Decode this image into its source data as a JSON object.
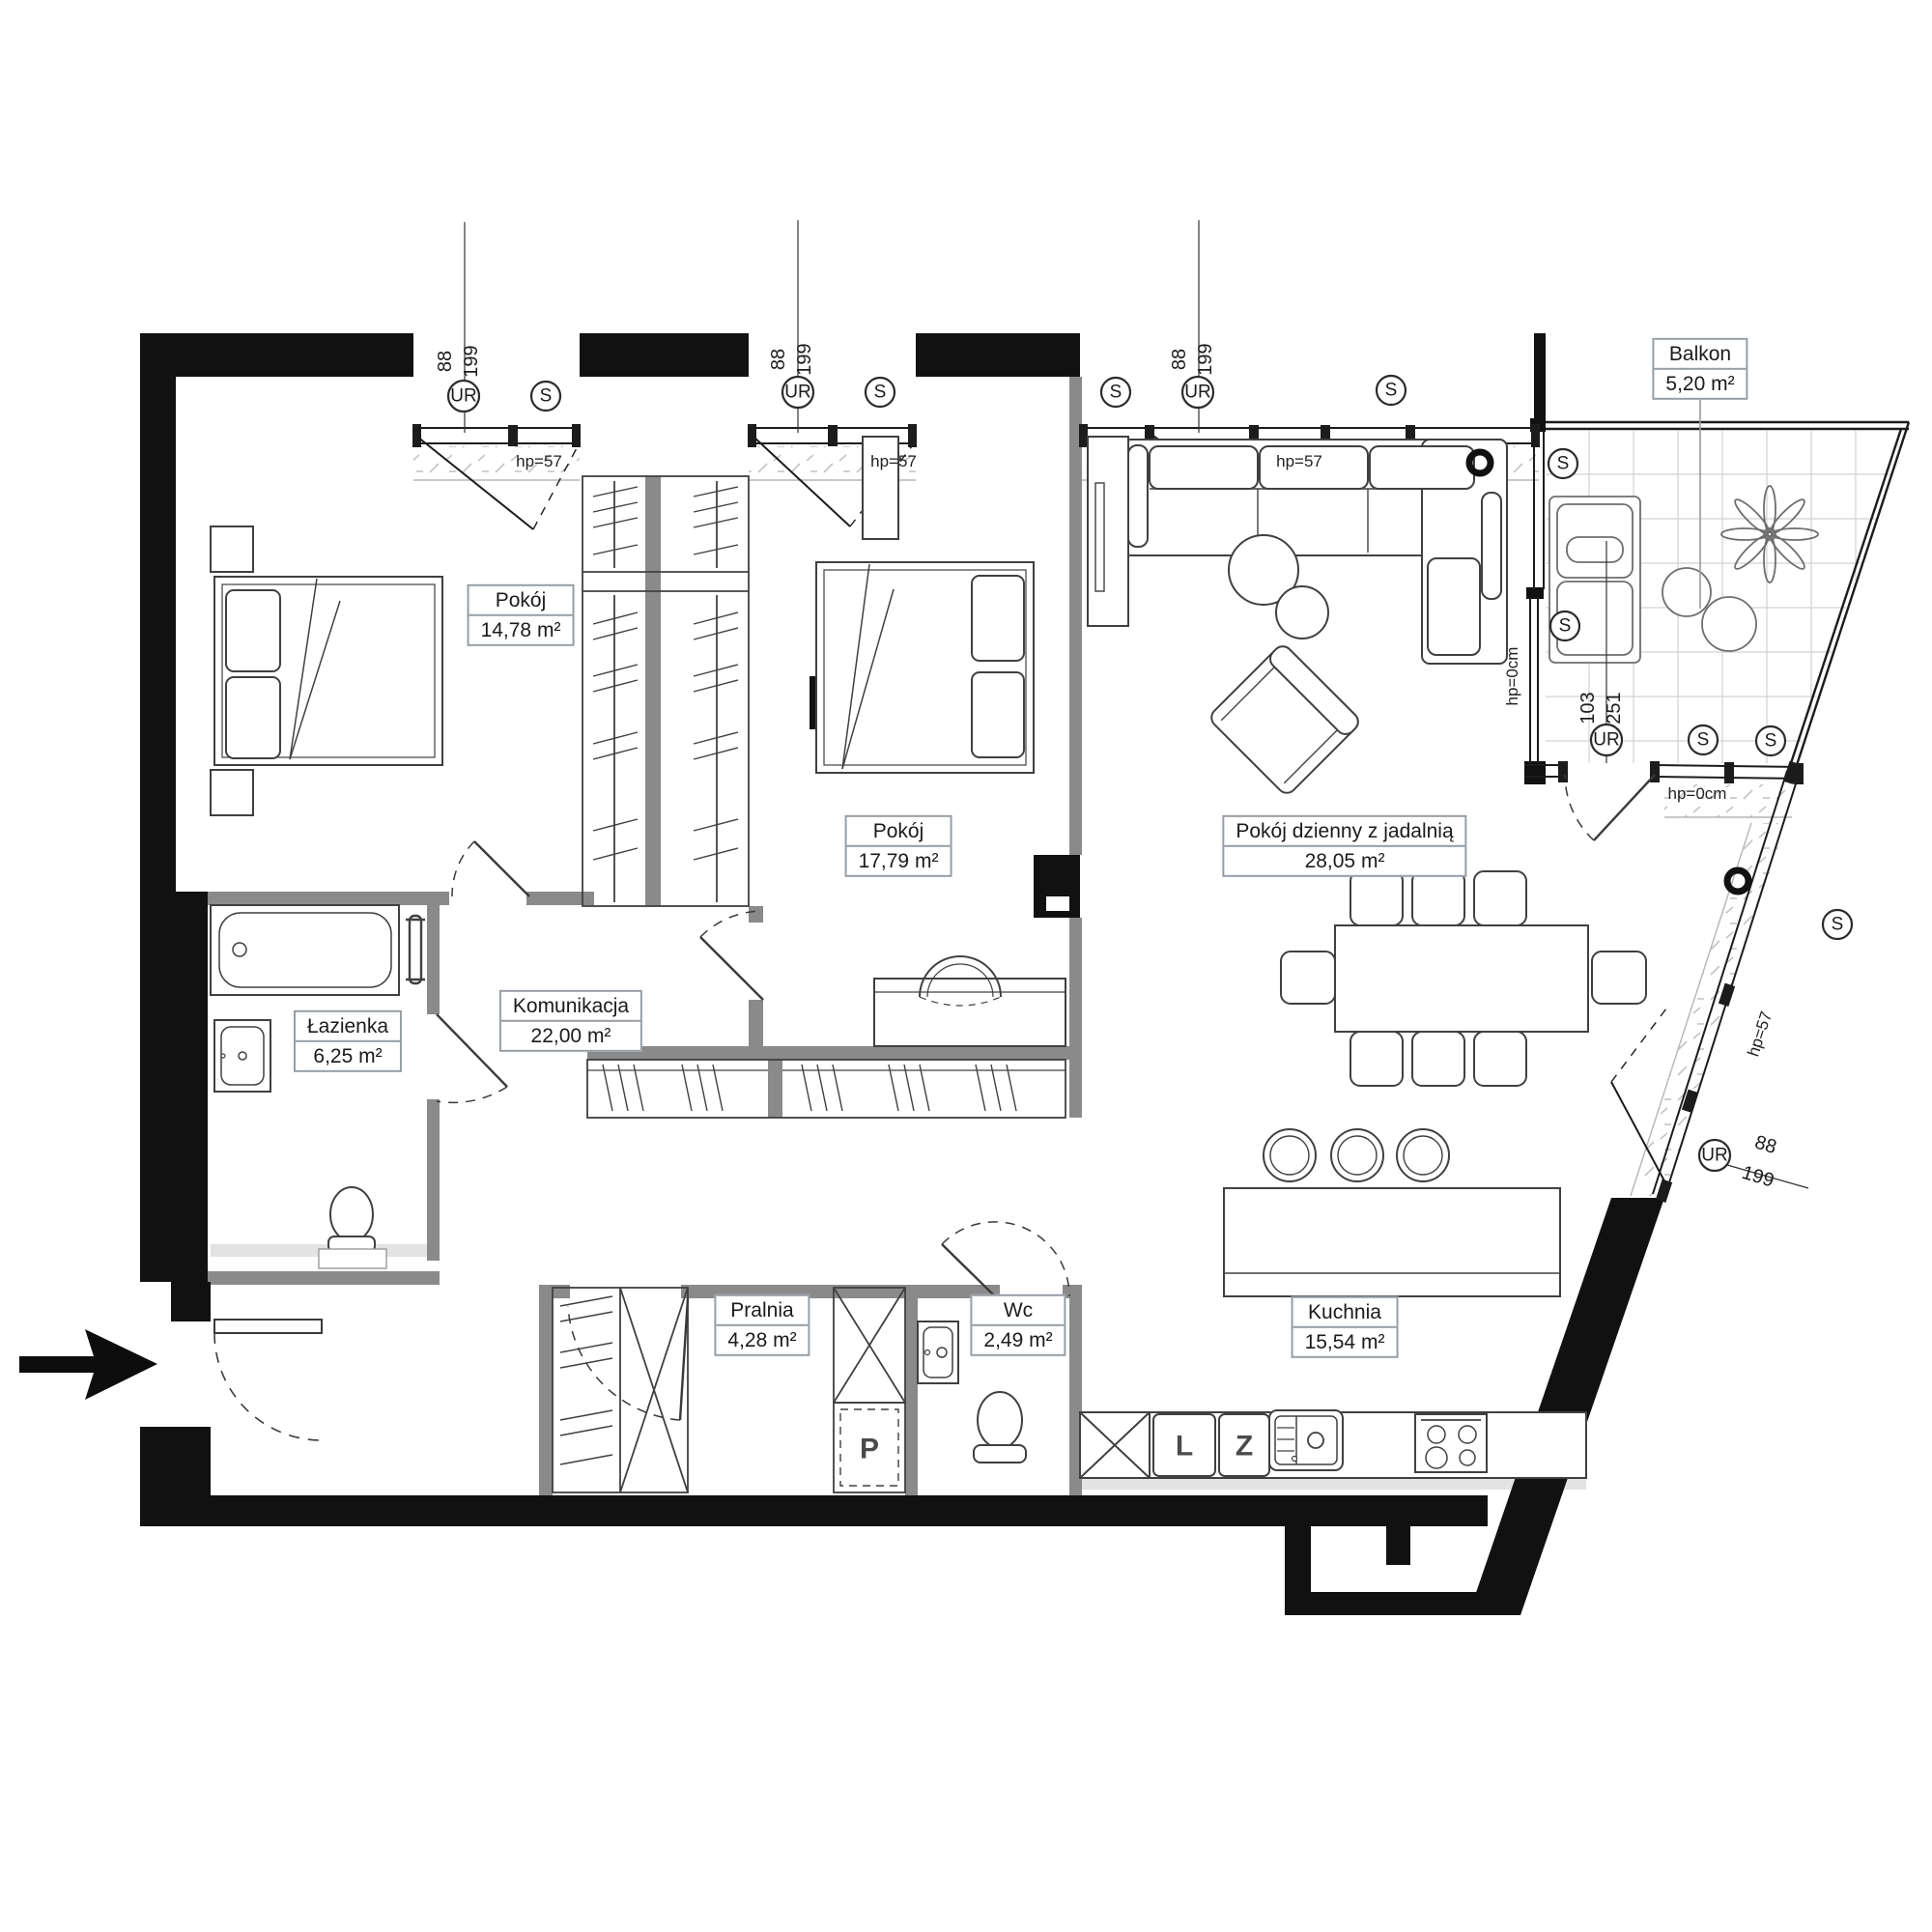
{
  "plan": {
    "rooms": [
      {
        "name": "Pokój",
        "area": "14,78 m²"
      },
      {
        "name": "Pokój",
        "area": "17,79 m²"
      },
      {
        "name": "Pokój dzienny z jadalnią",
        "area": "28,05 m²"
      },
      {
        "name": "Balkon",
        "area": "5,20 m²"
      },
      {
        "name": "Łazienka",
        "area": "6,25 m²"
      },
      {
        "name": "Komunikacja",
        "area": "22,00 m²"
      },
      {
        "name": "Pralnia",
        "area": "4,28 m²"
      },
      {
        "name": "Wc",
        "area": "2,49 m²"
      },
      {
        "name": "Kuchnia",
        "area": "15,54 m²"
      }
    ],
    "symbols": {
      "ur": "UR",
      "s": "S"
    },
    "labels": {
      "hp57": "hp=57",
      "hp0": "hp=0cm"
    },
    "dimensions": {
      "window": {
        "width": "88",
        "height": "199"
      },
      "balcony_door": {
        "width": "103",
        "height": "251"
      }
    },
    "appliances": {
      "washer": "P",
      "fridge": "L",
      "dishwasher": "Z"
    },
    "colors": {
      "wall": "#111111",
      "partition": "#8a8a8a",
      "furniture": "#404040",
      "hatch": "#c4c4c4"
    }
  }
}
